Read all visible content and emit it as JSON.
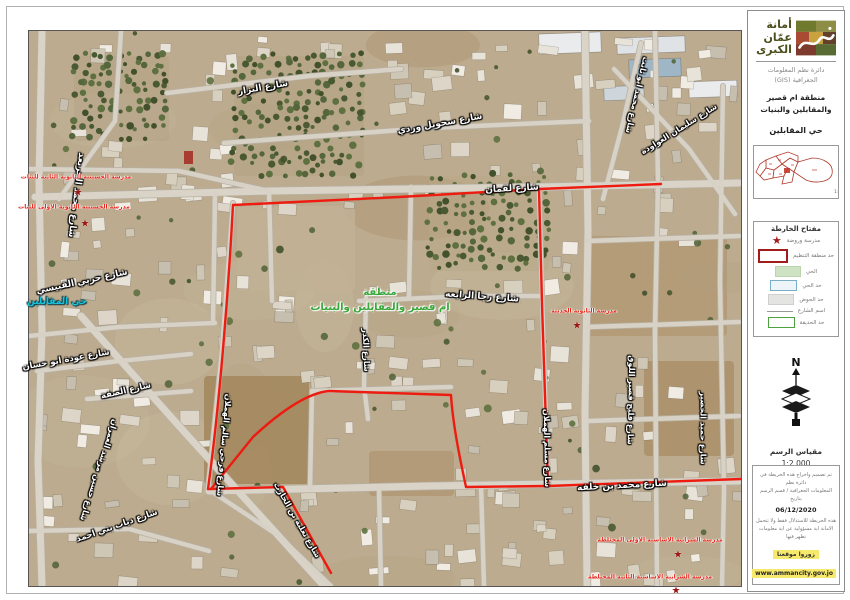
{
  "colors": {
    "boundary": "#ee1b10",
    "area_label": "#39a83c",
    "district_label": "#17c4dd",
    "school_label": "#e52619"
  },
  "sidebar": {
    "logo_title_1": "أمانة",
    "logo_title_2": "عمّان",
    "logo_title_3": "الكبرى",
    "dept_line1": "دائرة نظم المعلومات",
    "dept_line2": "الجغرافية (GIS)",
    "area_line1": "منطقة ام قصير",
    "area_line2": "والمقابلين والبنيات",
    "district_title": "حي المقابلين",
    "minimap_scale": "1:500,000",
    "legend": {
      "title": "مفتاح الخارطة",
      "items": [
        {
          "symbol": "star",
          "label": "مدرسة وروضة"
        },
        {
          "symbol": "rect-red",
          "label": "حد منطقة التنظيم"
        },
        {
          "symbol": "rect-green-fill",
          "label": "الحي"
        },
        {
          "symbol": "rect-blue",
          "label": "حد الحي"
        },
        {
          "symbol": "rect-gray-fill",
          "label": "حد الحوض"
        },
        {
          "symbol": "line",
          "label": "اسم الشارع"
        },
        {
          "symbol": "rect-green",
          "label": "حد الحديقة"
        }
      ]
    },
    "north_label": "N",
    "scale_label": "مقياس الرسم",
    "scale_value": "1:2,000",
    "footer": {
      "credit1": "تم تصميم واخراج هذه الخريطة في دائرة نظم",
      "credit2": "المعلومات الجغرافية / قسم الرسم بتاريخ",
      "date": "06/12/2020",
      "disclaimer1": "هذه الخريطة للاستدلال فقط ولا تتحمل",
      "disclaimer2": "الامانة اية مسؤولية عن اية معلومات تظهر فيها",
      "visit": "زوروا موقعنا",
      "website": "www.ammancity.gov.jo"
    }
  },
  "map": {
    "area_label_line1": "منطقة",
    "area_label_line2": "ام قصير والمقابلين والبنيات",
    "district_label": "حي المقابلين",
    "street_labels": [
      {
        "text": "شارع محمد الجريعد",
        "x": 76,
        "y": 195,
        "rot": 97,
        "size": 9
      },
      {
        "text": "شارع البزار",
        "x": 263,
        "y": 88,
        "rot": -10,
        "size": 9
      },
      {
        "text": "شارع سحويل وردي",
        "x": 440,
        "y": 124,
        "rot": -10,
        "size": 9
      },
      {
        "text": "شارع محمد ابو ثابت",
        "x": 637,
        "y": 95,
        "rot": 103,
        "size": 8
      },
      {
        "text": "شارع سليمان العواودة",
        "x": 679,
        "y": 129,
        "rot": -32,
        "size": 8
      },
      {
        "text": "شارع لقمان",
        "x": 512,
        "y": 189,
        "rot": -3,
        "size": 9
      },
      {
        "text": "شارع حربي القبيسي",
        "x": 82,
        "y": 282,
        "rot": -12,
        "size": 9
      },
      {
        "text": "شارع رجا الرابعه",
        "x": 482,
        "y": 297,
        "rot": 4,
        "size": 9
      },
      {
        "text": "شارع الكدر",
        "x": 366,
        "y": 350,
        "rot": 88,
        "size": 8
      },
      {
        "text": "شارع عودة ابو حسان",
        "x": 66,
        "y": 360,
        "rot": -10,
        "size": 8.5
      },
      {
        "text": "شارع الصفة",
        "x": 126,
        "y": 391,
        "rot": -13,
        "size": 8.5
      },
      {
        "text": "شارع حسين مرشد العمران",
        "x": 99,
        "y": 470,
        "rot": 108,
        "size": 8
      },
      {
        "text": "شارع دياب بني احمد",
        "x": 117,
        "y": 526,
        "rot": -19,
        "size": 8.5
      },
      {
        "text": "شارع فرحي سالم الهملان",
        "x": 224,
        "y": 445,
        "rot": 95,
        "size": 8
      },
      {
        "text": "شارع ثعلبة بن الحارث",
        "x": 297,
        "y": 520,
        "rot": 60,
        "size": 8
      },
      {
        "text": "شارع محمد بن خلفه",
        "x": 622,
        "y": 486,
        "rot": -3,
        "size": 9
      },
      {
        "text": "شارع مسلم الهملان",
        "x": 547,
        "y": 448,
        "rot": 89,
        "size": 8
      },
      {
        "text": "شارع فليح قصير اللوق",
        "x": 631,
        "y": 400,
        "rot": 91,
        "size": 8
      },
      {
        "text": "شارع حميد الخضير",
        "x": 703,
        "y": 428,
        "rot": 90,
        "size": 8
      }
    ],
    "school_labels": [
      {
        "text": "مدرسة الحسينية الثانوية الثانية للبنات",
        "x": 76,
        "y": 177,
        "sx": 78,
        "sy": 193
      },
      {
        "text": "مدرسة الحسينية الثانوية الاولى للبنات",
        "x": 74,
        "y": 207,
        "sx": 85,
        "sy": 224
      },
      {
        "text": "مدرسة الثانوية الحديثة",
        "x": 584,
        "y": 311,
        "sx": 577,
        "sy": 326
      },
      {
        "text": "مدرسة الشرابية الاساسية الاولى المختلطة",
        "x": 660,
        "y": 540,
        "sx": 678,
        "sy": 555
      },
      {
        "text": "مدرسة الشرابية الاساسية الثانية المختلطة",
        "x": 650,
        "y": 577,
        "sx": 676,
        "sy": 591
      }
    ]
  }
}
